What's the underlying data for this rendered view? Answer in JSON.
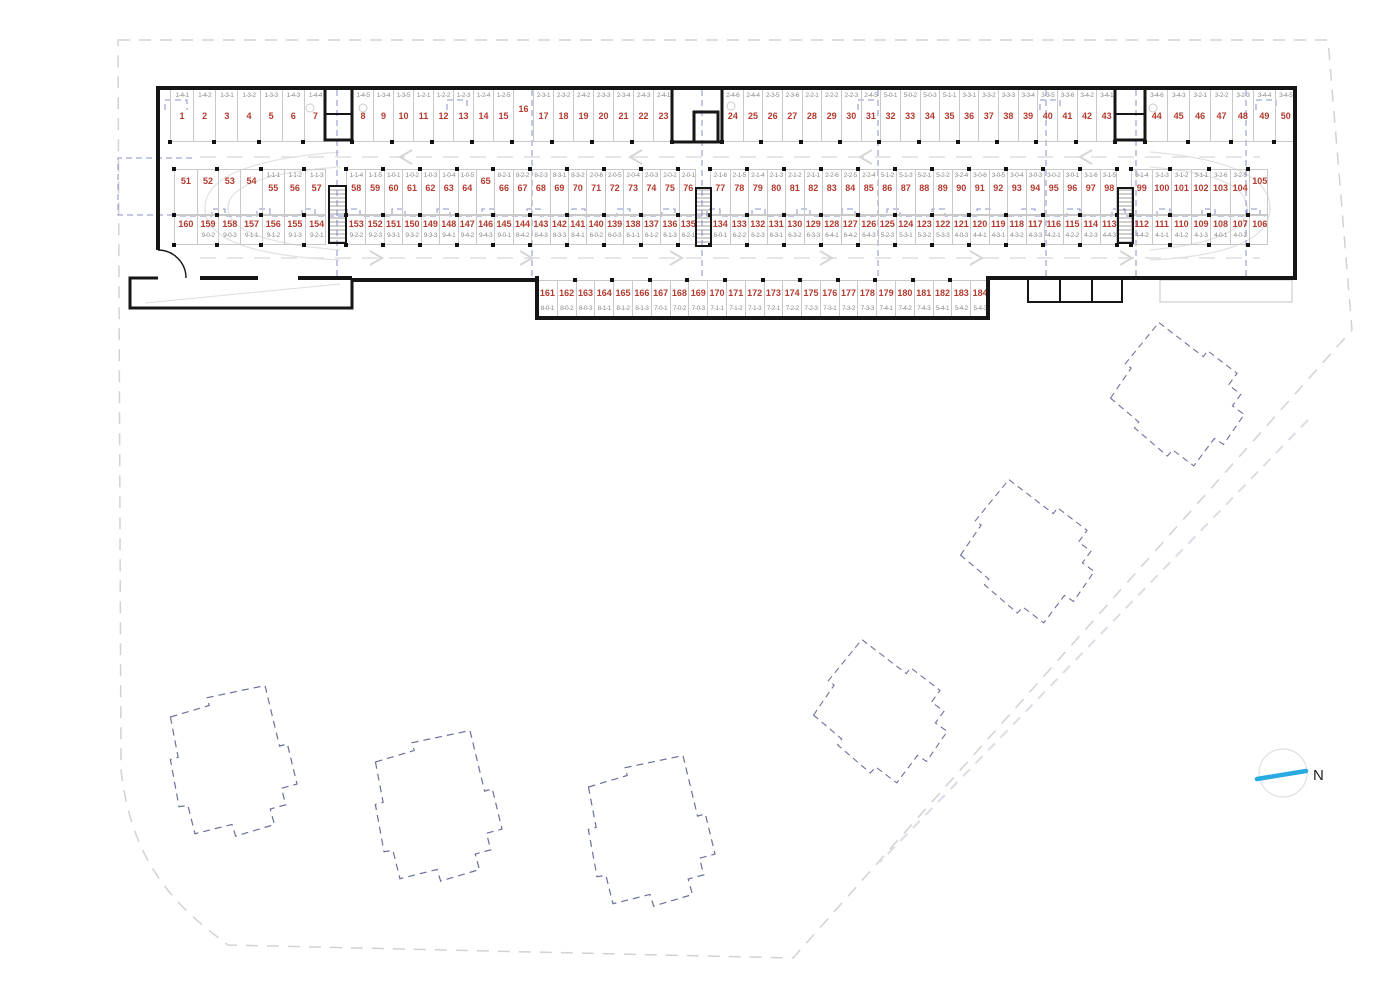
{
  "colors": {
    "stall_number": "#b43a2e",
    "unit_label": "#8a8a8a",
    "overlay_blue": "#8a8fcb",
    "north_arrow": "#29abe2",
    "wall": "#161616",
    "boundary": "#d2d2d2"
  },
  "north": {
    "label": "N"
  },
  "parking": {
    "rows": [
      {
        "id": "a",
        "y": 88,
        "h": 54,
        "label_first": true,
        "groups": [
          {
            "x1": 170,
            "x2": 325,
            "cells": [
              [
                "1",
                "1-4-1"
              ],
              [
                "2",
                "1-4-2"
              ],
              [
                "3",
                "1-3-1"
              ],
              [
                "4",
                "1-3-2"
              ],
              [
                "5",
                "1-3-3"
              ],
              [
                "6",
                "1-4-3"
              ],
              [
                "7",
                "1-4-4"
              ]
            ]
          },
          {
            "x1": 352,
            "x2": 672,
            "cells": [
              [
                "8",
                "1-4-5"
              ],
              [
                "9",
                "1-3-4"
              ],
              [
                "10",
                "1-3-5"
              ],
              [
                "11",
                "1-2-1"
              ],
              [
                "12",
                "1-2-2"
              ],
              [
                "13",
                "1-2-3"
              ],
              [
                "14",
                "1-2-4"
              ],
              [
                "15",
                "1-2-5"
              ],
              [
                "16",
                ""
              ],
              [
                "17",
                "2-3-1"
              ],
              [
                "18",
                "2-3-2"
              ],
              [
                "19",
                "2-4-2"
              ],
              [
                "20",
                "2-3-3"
              ],
              [
                "21",
                "2-3-4"
              ],
              [
                "22",
                "2-4-3"
              ],
              [
                "23",
                "2-4-1"
              ]
            ]
          },
          {
            "x1": 722,
            "x2": 1115,
            "cells": [
              [
                "24",
                "2-4-6"
              ],
              [
                "25",
                "2-4-4"
              ],
              [
                "26",
                "2-3-5"
              ],
              [
                "27",
                "2-3-6"
              ],
              [
                "28",
                "2-2-1"
              ],
              [
                "29",
                "2-2-2"
              ],
              [
                "30",
                "2-2-3"
              ],
              [
                "31",
                "2-4-5"
              ],
              [
                "32",
                "5-0-1"
              ],
              [
                "33",
                "5-0-2"
              ],
              [
                "34",
                "5-0-3"
              ],
              [
                "35",
                "5-1-1"
              ],
              [
                "36",
                "3-3-1"
              ],
              [
                "37",
                "3-3-2"
              ],
              [
                "38",
                "3-3-3"
              ],
              [
                "39",
                "3-3-4"
              ],
              [
                "40",
                "3-3-5"
              ],
              [
                "41",
                "3-3-6"
              ],
              [
                "42",
                "3-4-2"
              ],
              [
                "43",
                "3-4-1"
              ]
            ]
          },
          {
            "x1": 1145,
            "x2": 1295,
            "cells": [
              [
                "44",
                "3-4-6"
              ],
              [
                "45",
                "3-4-3"
              ],
              [
                "46",
                "3-2-1"
              ],
              [
                "47",
                "3-2-2"
              ],
              [
                "48",
                "3-2-3"
              ],
              [
                "49",
                "3-4-4"
              ],
              [
                "50",
                "3-4-5"
              ]
            ]
          }
        ]
      },
      {
        "id": "b",
        "y": 169,
        "h": 46,
        "label_first": true,
        "groups": [
          {
            "x1": 174,
            "x2": 326,
            "cells": [
              [
                "51",
                ""
              ],
              [
                "52",
                ""
              ],
              [
                "53",
                ""
              ],
              [
                "54",
                ""
              ],
              [
                "55",
                "1-1-1"
              ],
              [
                "56",
                "1-1-2"
              ],
              [
                "57",
                "1-1-3"
              ]
            ]
          },
          {
            "x1": 346,
            "x2": 696,
            "cells": [
              [
                "58",
                "1-1-4"
              ],
              [
                "59",
                "1-1-5"
              ],
              [
                "60",
                "1-0-1"
              ],
              [
                "61",
                "1-0-2"
              ],
              [
                "62",
                "1-0-3"
              ],
              [
                "63",
                "1-0-4"
              ],
              [
                "64",
                "1-0-5"
              ],
              [
                "65",
                ""
              ],
              [
                "66",
                "8-2-1"
              ],
              [
                "67",
                "8-2-2"
              ],
              [
                "68",
                "8-2-3"
              ],
              [
                "69",
                "8-3-1"
              ],
              [
                "70",
                "8-3-2"
              ],
              [
                "71",
                "2-0-6"
              ],
              [
                "72",
                "2-0-5"
              ],
              [
                "73",
                "2-0-4"
              ],
              [
                "74",
                "2-0-3"
              ],
              [
                "75",
                "2-0-2"
              ],
              [
                "76",
                "2-0-1"
              ]
            ]
          },
          {
            "x1": 710,
            "x2": 1117,
            "cells": [
              [
                "77",
                "2-1-6"
              ],
              [
                "78",
                "2-1-5"
              ],
              [
                "79",
                "2-1-4"
              ],
              [
                "80",
                "2-1-3"
              ],
              [
                "81",
                "2-1-2"
              ],
              [
                "82",
                "2-1-1"
              ],
              [
                "83",
                "2-2-6"
              ],
              [
                "84",
                "2-2-5"
              ],
              [
                "85",
                "2-2-4"
              ],
              [
                "86",
                "5-1-2"
              ],
              [
                "87",
                "5-1-3"
              ],
              [
                "88",
                "5-2-1"
              ],
              [
                "89",
                "5-2-2"
              ],
              [
                "90",
                "3-2-4"
              ],
              [
                "91",
                "3-0-6"
              ],
              [
                "92",
                "3-0-5"
              ],
              [
                "93",
                "3-0-4"
              ],
              [
                "94",
                "3-0-3"
              ],
              [
                "95",
                "3-0-2"
              ],
              [
                "96",
                "3-0-1"
              ],
              [
                "97",
                "3-1-6"
              ],
              [
                "98",
                "3-1-5"
              ]
            ]
          },
          {
            "x1": 1131,
            "x2": 1268,
            "cells": [
              [
                "99",
                "3-1-4"
              ],
              [
                "100",
                "3-1-3"
              ],
              [
                "101",
                "3-1-2"
              ],
              [
                "102",
                "3-1-1"
              ],
              [
                "103",
                "3-2-6"
              ],
              [
                "104",
                "3-2-5"
              ],
              [
                "105",
                ""
              ]
            ]
          }
        ]
      },
      {
        "id": "c",
        "y": 215,
        "h": 30,
        "label_first": false,
        "groups": [
          {
            "x1": 174,
            "x2": 326,
            "cells": [
              [
                "160",
                ""
              ],
              [
                "159",
                "9-0-2"
              ],
              [
                "158",
                "9-0-3"
              ],
              [
                "157",
                "9-1-1"
              ],
              [
                "156",
                "9-1-2"
              ],
              [
                "155",
                "9-1-3"
              ],
              [
                "154",
                "9-2-1"
              ]
            ]
          },
          {
            "x1": 346,
            "x2": 696,
            "cells": [
              [
                "153",
                "9-2-2"
              ],
              [
                "152",
                "9-2-3"
              ],
              [
                "151",
                "9-3-1"
              ],
              [
                "150",
                "9-3-2"
              ],
              [
                "149",
                "9-3-3"
              ],
              [
                "148",
                "9-4-1"
              ],
              [
                "147",
                "9-4-2"
              ],
              [
                "146",
                "9-4-3"
              ],
              [
                "145",
                "9-0-1"
              ],
              [
                "144",
                "8-4-2"
              ],
              [
                "143",
                "8-4-3"
              ],
              [
                "142",
                "8-3-3"
              ],
              [
                "141",
                "8-4-1"
              ],
              [
                "140",
                "6-0-2"
              ],
              [
                "139",
                "6-0-3"
              ],
              [
                "138",
                "6-1-1"
              ],
              [
                "137",
                "6-1-2"
              ],
              [
                "136",
                "6-1-3"
              ],
              [
                "135",
                "6-2-1"
              ]
            ]
          },
          {
            "x1": 710,
            "x2": 1117,
            "cells": [
              [
                "134",
                "6-0-1"
              ],
              [
                "133",
                "6-2-2"
              ],
              [
                "132",
                "6-2-3"
              ],
              [
                "131",
                "6-3-1"
              ],
              [
                "130",
                "6-3-2"
              ],
              [
                "129",
                "6-3-3"
              ],
              [
                "128",
                "6-4-1"
              ],
              [
                "127",
                "6-4-2"
              ],
              [
                "126",
                "6-4-3"
              ],
              [
                "125",
                "5-2-3"
              ],
              [
                "124",
                "5-3-1"
              ],
              [
                "123",
                "5-3-2"
              ],
              [
                "122",
                "5-3-3"
              ],
              [
                "121",
                "4-0-3"
              ],
              [
                "120",
                "4-4-1"
              ],
              [
                "119",
                "4-3-1"
              ],
              [
                "118",
                "4-3-2"
              ],
              [
                "117",
                "4-3-3"
              ],
              [
                "116",
                "4-2-1"
              ],
              [
                "115",
                "4-2-2"
              ],
              [
                "114",
                "4-2-3"
              ],
              [
                "113",
                "4-4-3"
              ]
            ]
          },
          {
            "x1": 1131,
            "x2": 1268,
            "cells": [
              [
                "112",
                "4-4-2"
              ],
              [
                "111",
                "4-1-1"
              ],
              [
                "110",
                "4-1-2"
              ],
              [
                "109",
                "4-1-3"
              ],
              [
                "108",
                "4-0-1"
              ],
              [
                "107",
                "4-0-2"
              ],
              [
                "106",
                ""
              ]
            ]
          }
        ]
      },
      {
        "id": "d",
        "y": 280,
        "h": 38,
        "label_first": false,
        "groups": [
          {
            "x1": 537,
            "x2": 988,
            "cells": [
              [
                "161",
                "8-0-1"
              ],
              [
                "162",
                "8-0-2"
              ],
              [
                "163",
                "8-0-3"
              ],
              [
                "164",
                "8-1-1"
              ],
              [
                "165",
                "8-1-2"
              ],
              [
                "166",
                "8-1-3"
              ],
              [
                "167",
                "7-0-1"
              ],
              [
                "168",
                "7-0-2"
              ],
              [
                "169",
                "7-0-3"
              ],
              [
                "170",
                "7-1-1"
              ],
              [
                "171",
                "7-1-2"
              ],
              [
                "172",
                "7-1-3"
              ],
              [
                "173",
                "7-2-1"
              ],
              [
                "174",
                "7-2-2"
              ],
              [
                "175",
                "7-2-3"
              ],
              [
                "176",
                "7-3-1"
              ],
              [
                "177",
                "7-3-2"
              ],
              [
                "178",
                "7-3-3"
              ],
              [
                "179",
                "7-4-1"
              ],
              [
                "180",
                "7-4-2"
              ],
              [
                "181",
                "7-4-3"
              ],
              [
                "182",
                "5-4-1"
              ],
              [
                "183",
                "5-4-2"
              ],
              [
                "184",
                "5-4-3"
              ]
            ]
          }
        ]
      }
    ]
  }
}
